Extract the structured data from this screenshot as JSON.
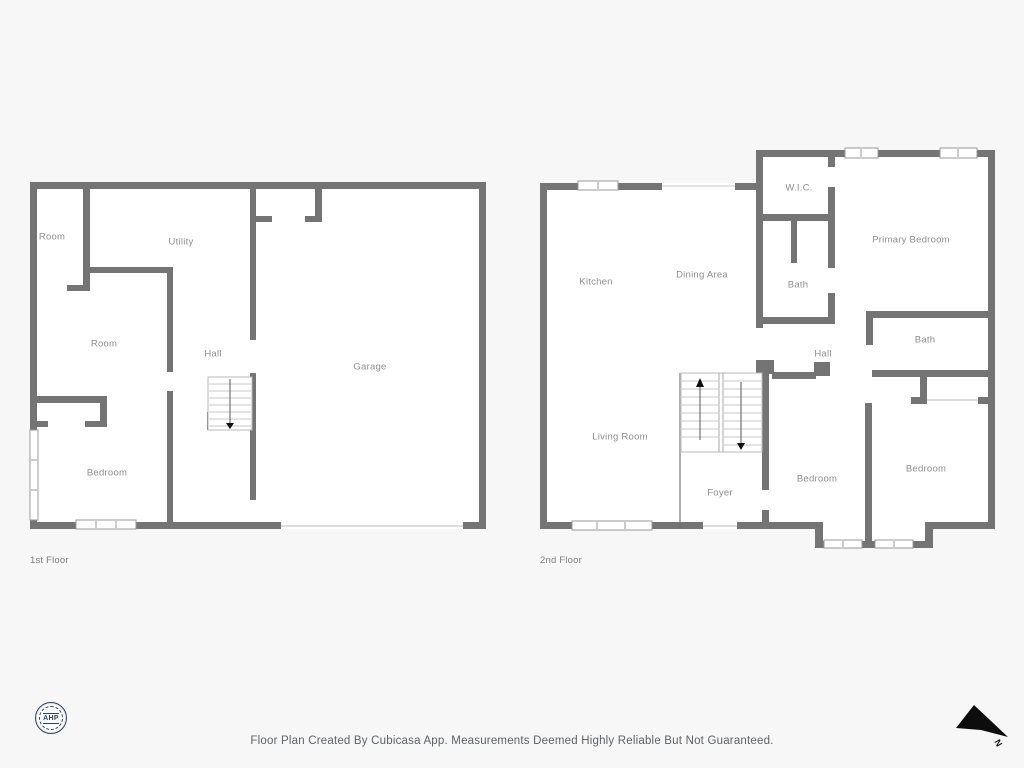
{
  "colors": {
    "background": "#f7f7f7",
    "wall": "#747474",
    "floor_fill": "#ffffff",
    "label_gray": "#8d8d8d",
    "thin_line": "#c4c4c4",
    "logo_navy": "#31415f",
    "north_arrow": "#0d0d0d"
  },
  "floors": [
    {
      "title": "1st Floor",
      "rooms": [
        {
          "label": "Room"
        },
        {
          "label": "Utility"
        },
        {
          "label": "Room"
        },
        {
          "label": "Hall"
        },
        {
          "label": "Garage"
        },
        {
          "label": "Bedroom"
        }
      ]
    },
    {
      "title": "2nd Floor",
      "rooms": [
        {
          "label": "Kitchen"
        },
        {
          "label": "Dining Area"
        },
        {
          "label": "W.I.C."
        },
        {
          "label": "Primary Bedroom"
        },
        {
          "label": "Bath"
        },
        {
          "label": "Hall"
        },
        {
          "label": "Bath"
        },
        {
          "label": "Living Room"
        },
        {
          "label": "Foyer"
        },
        {
          "label": "Bedroom"
        },
        {
          "label": "Bedroom"
        }
      ]
    }
  ],
  "footer": {
    "disclaimer": "Floor Plan Created By Cubicasa App. Measurements Deemed Highly Reliable But Not Guaranteed."
  },
  "logo": {
    "text": "AHP"
  },
  "compass": {
    "label": "N"
  }
}
